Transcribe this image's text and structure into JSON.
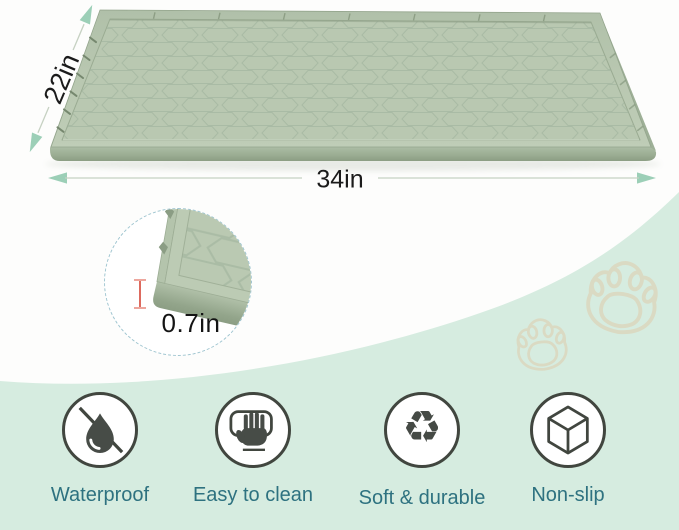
{
  "dimensions": {
    "width": "34in",
    "depth": "22in",
    "height": "0.7in"
  },
  "features": [
    {
      "label": "Waterproof",
      "icon": "no-water-drop-icon"
    },
    {
      "label": "Easy to clean",
      "icon": "hand-wipe-icon"
    },
    {
      "label": "Soft & durable",
      "icon": "recycle-icon",
      "glyph": "♻"
    },
    {
      "label": "Non-slip",
      "icon": "cube-icon"
    }
  ],
  "colors": {
    "mat_sage": "#b8c7b0",
    "mat_side": "#8fa288",
    "arrow_teal": "#9ccfb7",
    "label_teal": "#2e7280",
    "mint_band": "#d6ece0",
    "measure_red": "#dd6a5e",
    "paw_outline": "#dcd6bd",
    "icon_dark": "#41463f"
  }
}
